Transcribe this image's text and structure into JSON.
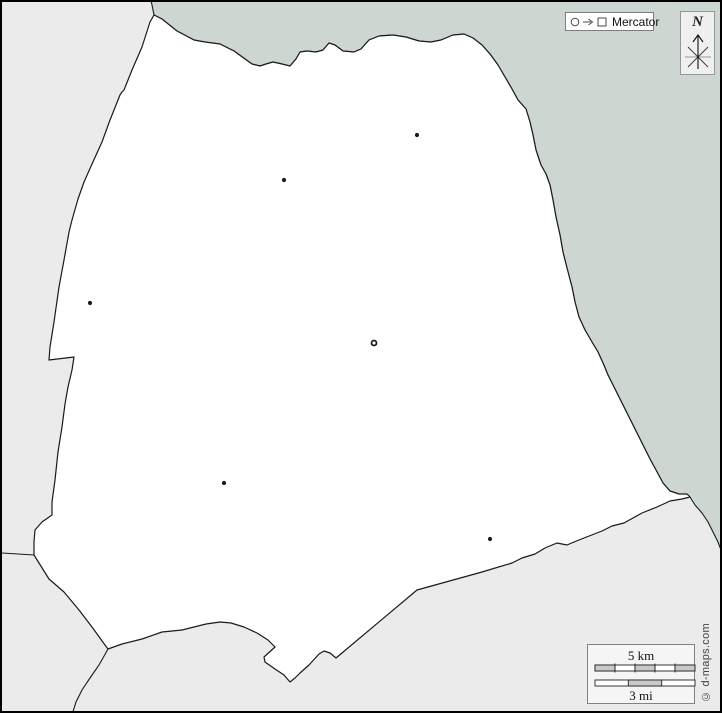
{
  "map": {
    "projection_label": "Mercator",
    "compass_label": "N",
    "copyright": "© d-maps.com",
    "scale": {
      "km_label": "5 km",
      "mi_label": "3 mi"
    },
    "colors": {
      "sea": "#cdd6d0",
      "neighbor_land": "#ebebeb",
      "main_land": "#ffffff",
      "boundary_line": "#1a1a1a",
      "marker": "#1c1c1c"
    },
    "markers": {
      "capital": {
        "x": 372,
        "y": 341
      },
      "towns": [
        {
          "x": 415,
          "y": 133
        },
        {
          "x": 282,
          "y": 178
        },
        {
          "x": 88,
          "y": 301
        },
        {
          "x": 222,
          "y": 481
        },
        {
          "x": 488,
          "y": 537
        }
      ]
    }
  }
}
